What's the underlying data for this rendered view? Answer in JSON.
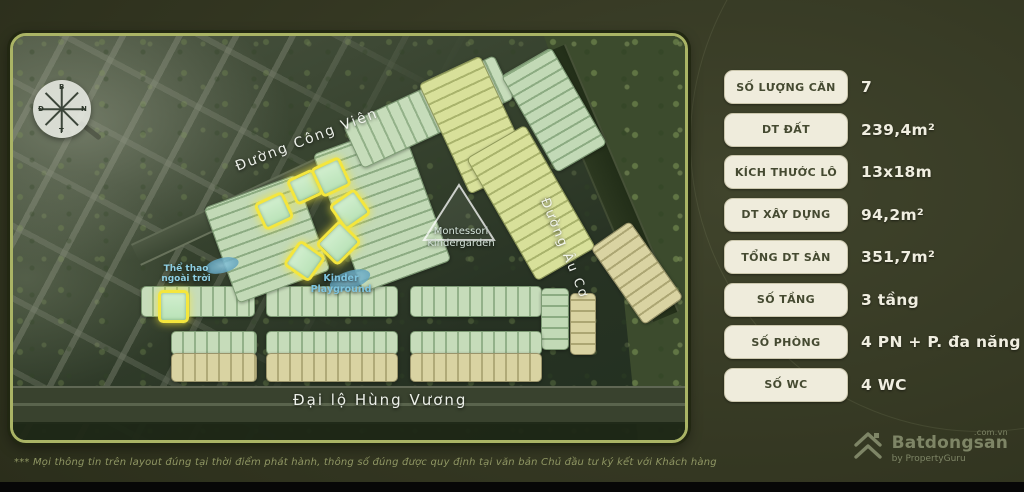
{
  "map": {
    "streets": {
      "cong_vien": "Đường Công Viên",
      "au_co": "Đường Âu Cơ",
      "hung_vuong": "Đại lộ Hùng Vương"
    },
    "pois": {
      "outdoor_sports_l1": "Thể thao",
      "outdoor_sports_l2": "ngoài trời",
      "playground_l1": "Kinder",
      "playground_l2": "Playground",
      "montessori_l1": "Montessori",
      "montessori_l2": "Kindergarden"
    },
    "compass": {
      "north": "B",
      "east": "Đ",
      "south": "N",
      "west": "T"
    }
  },
  "specs": {
    "rows": [
      {
        "label": "SỐ LƯỢNG CĂN",
        "value": "7"
      },
      {
        "label": "DT ĐẤT",
        "value": "239,4m²"
      },
      {
        "label": "KÍCH THƯỚC LÔ",
        "value": "13x18m"
      },
      {
        "label": "DT XÂY DỰNG",
        "value": "94,2m²"
      },
      {
        "label": "TỔNG DT SÀN",
        "value": "351,7m²"
      },
      {
        "label": "SỐ TẦNG",
        "value": "3 tầng"
      },
      {
        "label": "SỐ PHÒNG",
        "value": "4 PN + P. đa năng"
      },
      {
        "label": "SỐ WC",
        "value": "4 WC"
      }
    ]
  },
  "footer": {
    "disclaimer": "*** Mọi thông tin trên layout đúng tại thời điểm phát hành, thông số đúng được quy định tại văn bản Chủ đầu tư ký kết với Khách hàng"
  },
  "branding": {
    "name": "Batdongsan",
    "domain": ".com.vn",
    "byline": "by PropertyGuru"
  },
  "colors": {
    "highlight_yellow": "#f4e63d",
    "spec_button_bg": "#efecdc",
    "spec_button_text": "#454a31",
    "value_text": "#f0eee0",
    "frame_border": "#aab465",
    "poi_blue": "#7ec4de"
  }
}
